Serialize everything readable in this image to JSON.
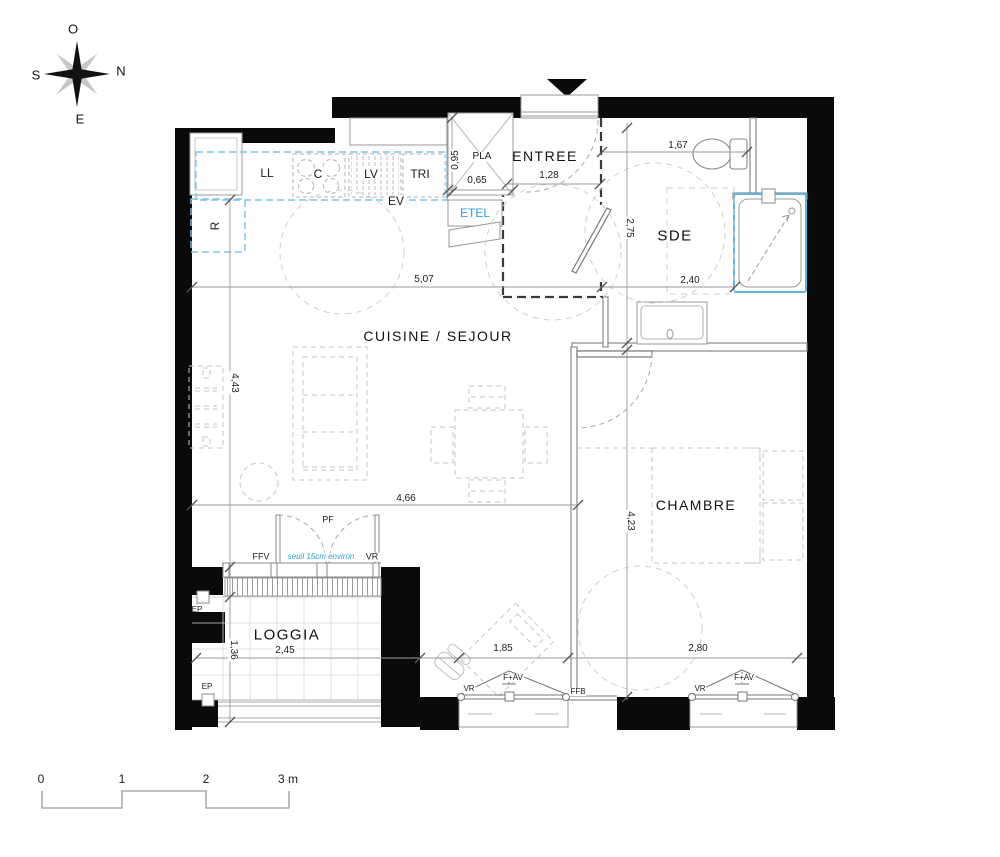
{
  "compass": {
    "o": "O",
    "n": "N",
    "s": "S",
    "e": "E"
  },
  "rooms": {
    "entree": "ENTREE",
    "sde": "SDE",
    "cuisine_sejour": "CUISINE / SEJOUR",
    "chambre": "CHAMBRE",
    "loggia": "LOGGIA"
  },
  "kitchen": {
    "ll": "LL",
    "c": "C",
    "lv": "LV",
    "tri": "TRI",
    "ev": "EV",
    "r": "R"
  },
  "closets": {
    "pla": "PLA",
    "etel": "ETEL"
  },
  "dims": {
    "pla_h": "0,95",
    "pla_w": "0,65",
    "entree_w": "1,28",
    "sde_top": "1,67",
    "sde_h": "2,75",
    "sde_w": "2,40",
    "sejour_w": "5,07",
    "sejour_h": "4,43",
    "sejour_b": "4,66",
    "chambre_h": "4,23",
    "loggia_h": "1,36",
    "loggia_w": "2,45",
    "win1_w": "1,85",
    "chambre_w": "2,80"
  },
  "openings": {
    "pf": "PF",
    "ffv": "FFV",
    "vr_loggia": "VR",
    "seuil": "seuil 15cm environ",
    "ep_top": "EP",
    "ep_bottom": "EP",
    "win1_vr": "VR",
    "win1_fav": "F+AV",
    "ffb": "FFB",
    "win2_vr": "VR",
    "win2_fav": "F+AV"
  },
  "scale": {
    "t0": "0",
    "t1": "1",
    "t2": "2",
    "t3": "3 m"
  },
  "colors": {
    "wall": "#000000",
    "accent_blue": "#2f9fd6",
    "line": "#8a8a8a"
  }
}
